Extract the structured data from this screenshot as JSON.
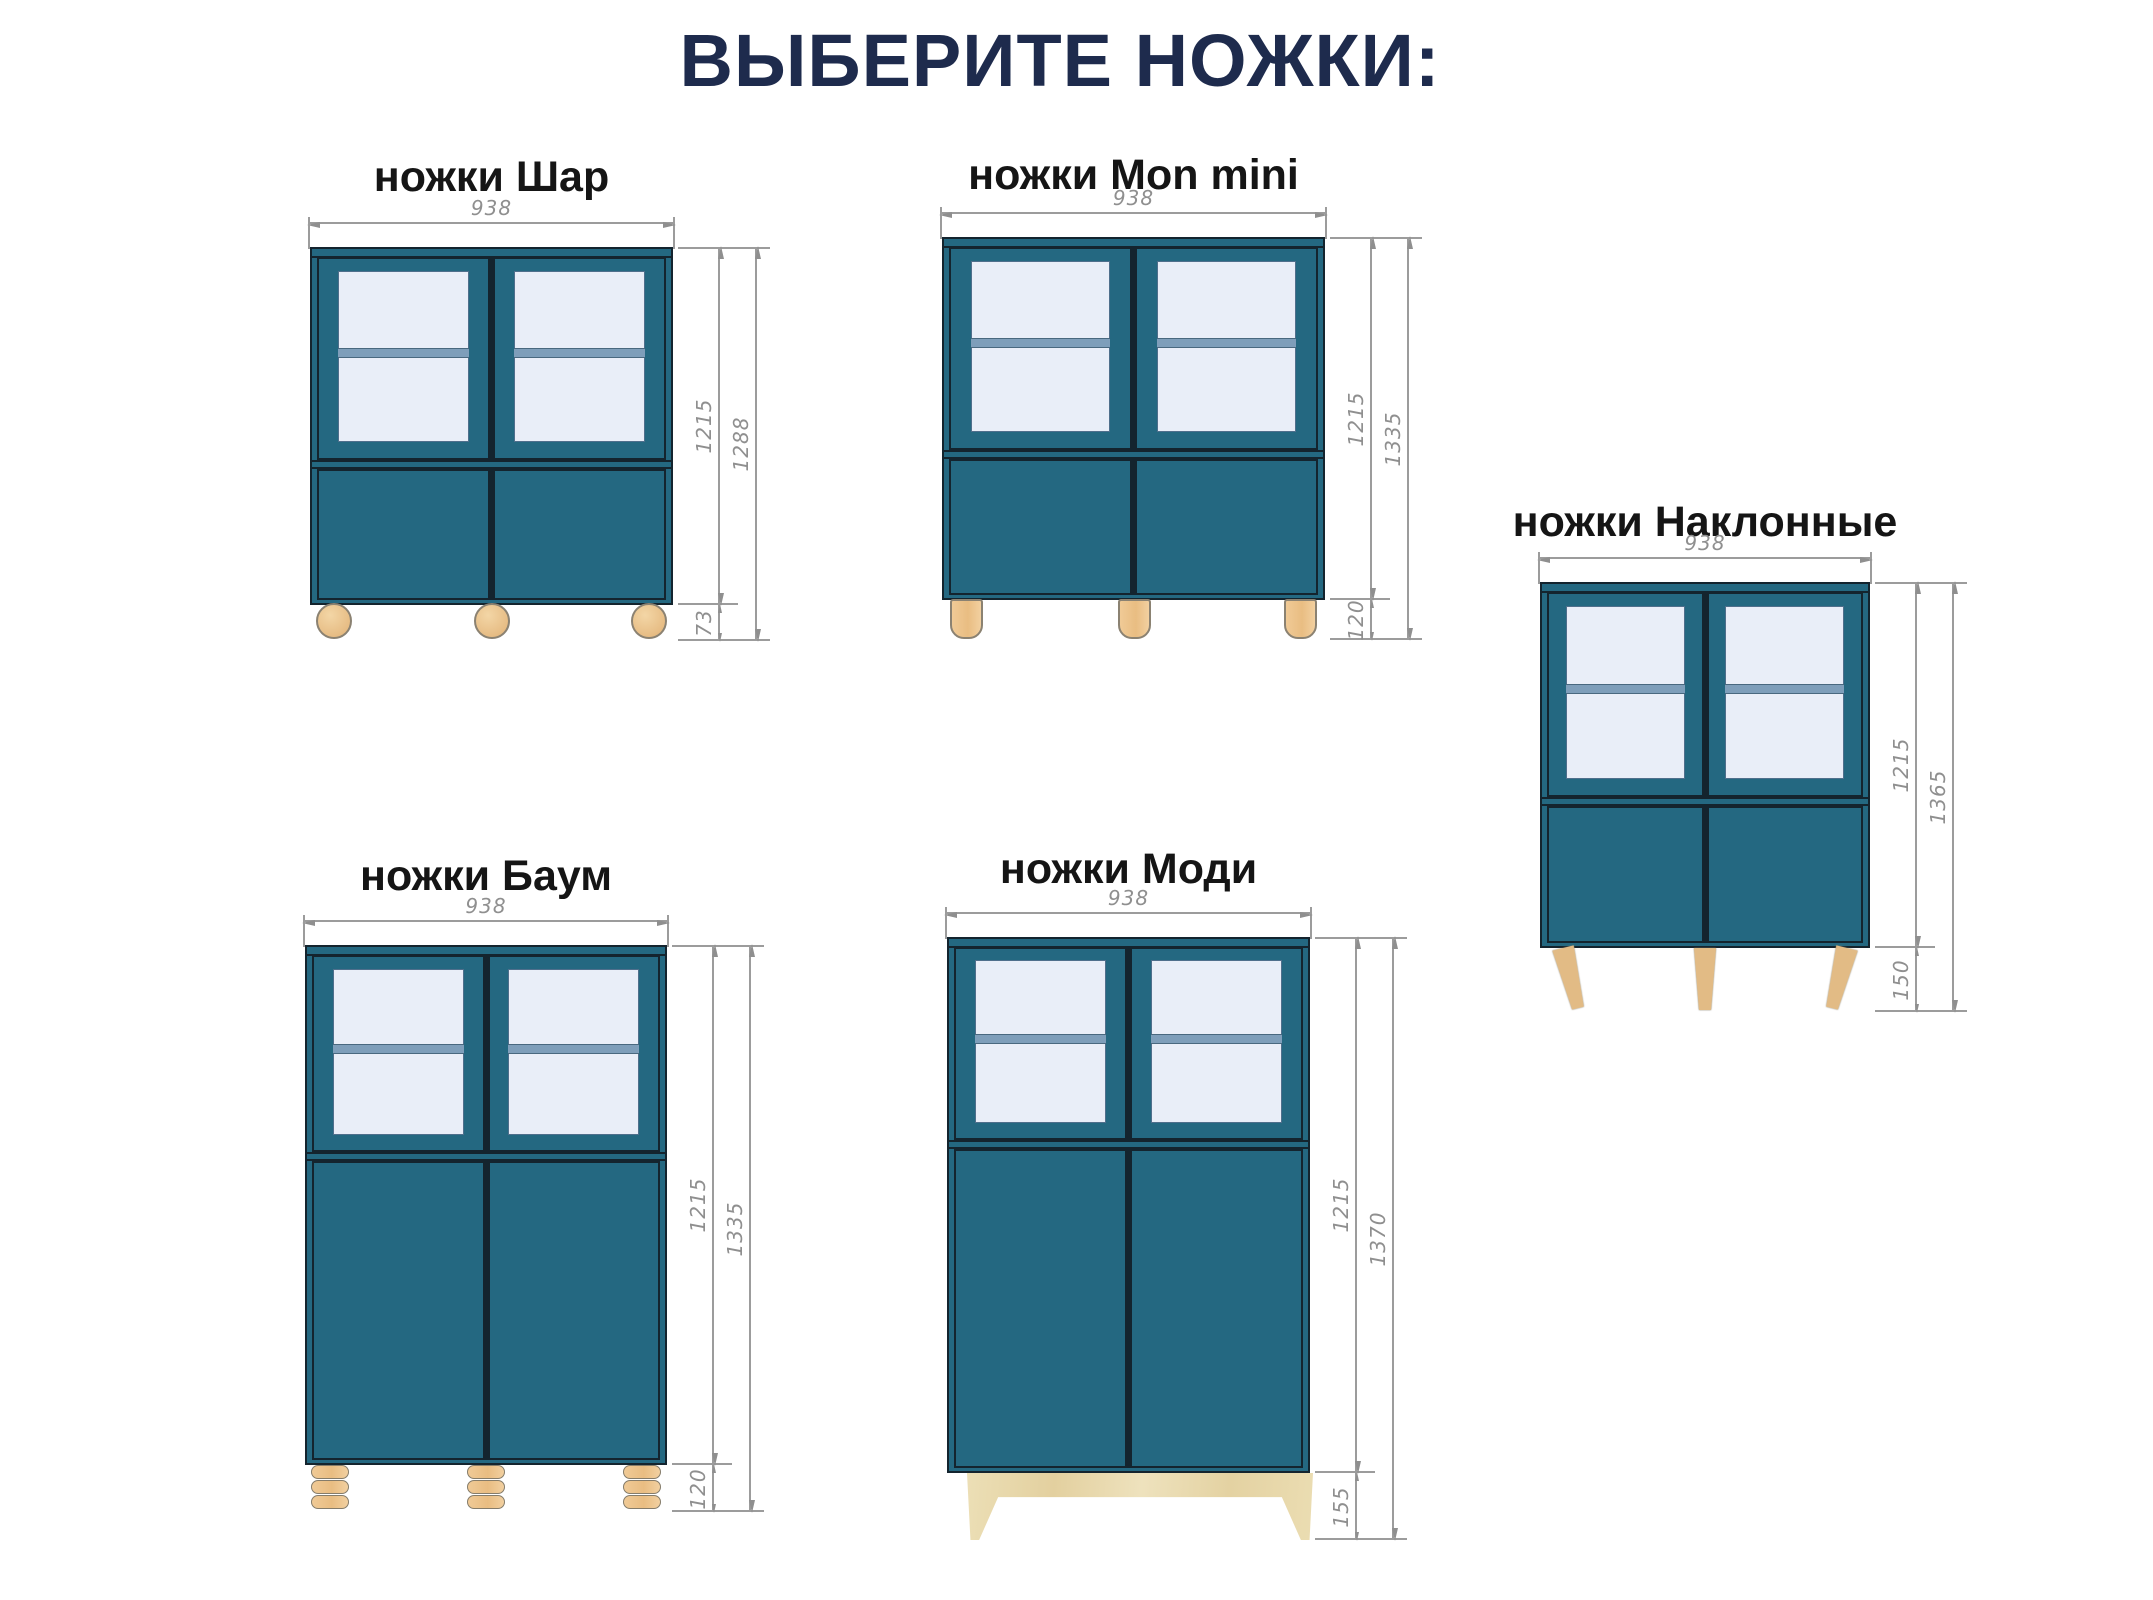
{
  "title": "ВЫБЕРИТЕ НОЖКИ:",
  "variants": [
    {
      "label": "ножки Шар",
      "leg_type": "ball",
      "dims": {
        "width": "938",
        "body_height": "1215",
        "total_height": "1288",
        "leg_height": "73"
      }
    },
    {
      "label": "ножки Mon mini",
      "leg_type": "cylinder",
      "dims": {
        "width": "938",
        "body_height": "1215",
        "total_height": "1335",
        "leg_height": "120"
      }
    },
    {
      "label": "ножки Наклонные",
      "leg_type": "slanted",
      "dims": {
        "width": "938",
        "body_height": "1215",
        "total_height": "1365",
        "leg_height": "150"
      }
    },
    {
      "label": "ножки Баум",
      "leg_type": "stacked-discs",
      "dims": {
        "width": "938",
        "body_height": "1215",
        "total_height": "1335",
        "leg_height": "120"
      }
    },
    {
      "label": "ножки Моди",
      "leg_type": "plinth",
      "dims": {
        "width": "938",
        "body_height": "1215",
        "total_height": "1370",
        "leg_height": "155"
      }
    }
  ],
  "colors": {
    "cabinet_teal": "#246881",
    "glass": "#e9eef8",
    "shelf_band": "#7e9eba",
    "outline_dark": "#14242e",
    "wood_leg_tan": "#e9bd82",
    "plywood": "#e8d9ae",
    "dimension_gray": "#8f8f8f",
    "title_navy": "#1e2b4d",
    "label_black": "#151515"
  }
}
